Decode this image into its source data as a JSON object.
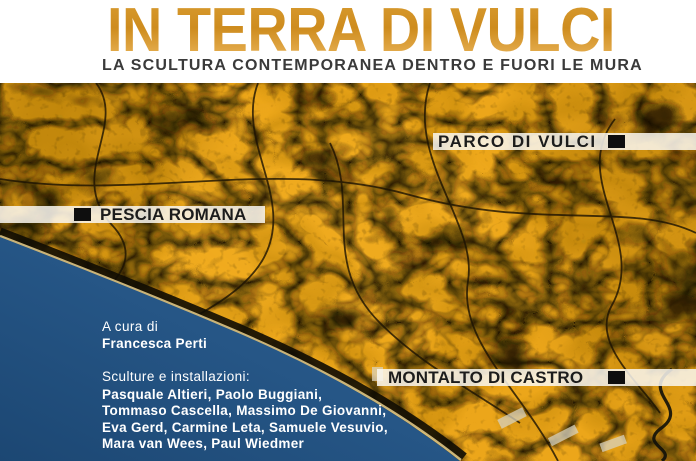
{
  "header": {
    "title": "IN TERRA DI VULCI",
    "subtitle": "LA SCULTURA CONTEMPORANEA DENTRO E FUORI LE MURA"
  },
  "map": {
    "labels": {
      "parco": {
        "text": "PARCO DI VULCI"
      },
      "pescia": {
        "text": "PESCIA ROMANA"
      },
      "montalto": {
        "text": "MONTALTO DI CASTRO"
      }
    },
    "marker_icon": "black-square"
  },
  "credits": {
    "curator_label": "A cura di",
    "curator_name": "Francesca Perti",
    "section_label": "Sculture e installazioni:",
    "artists_lines": [
      "Pasquale Altieri, Paolo Buggiani,",
      "Tommaso Cascella, Massimo De Giovanni,",
      "Eva Gerd, Carmine Leta, Samuele Vesuvio,",
      "Mara van Wees, Paul Wiedmer"
    ]
  },
  "colors": {
    "title_top": "#d89b30",
    "title_mid": "#ce8c1e",
    "title_bottom": "#ebb65c",
    "subtitle": "#3a3a3a",
    "band_bg": "rgba(250,248,242,0.85)",
    "label_text": "#1c1c1c",
    "marker": "#0e0e0e",
    "credits_text": "#ffffff",
    "land": "#eca61a",
    "sea_top": "#2f6498",
    "sea_bottom": "#1c4773"
  }
}
